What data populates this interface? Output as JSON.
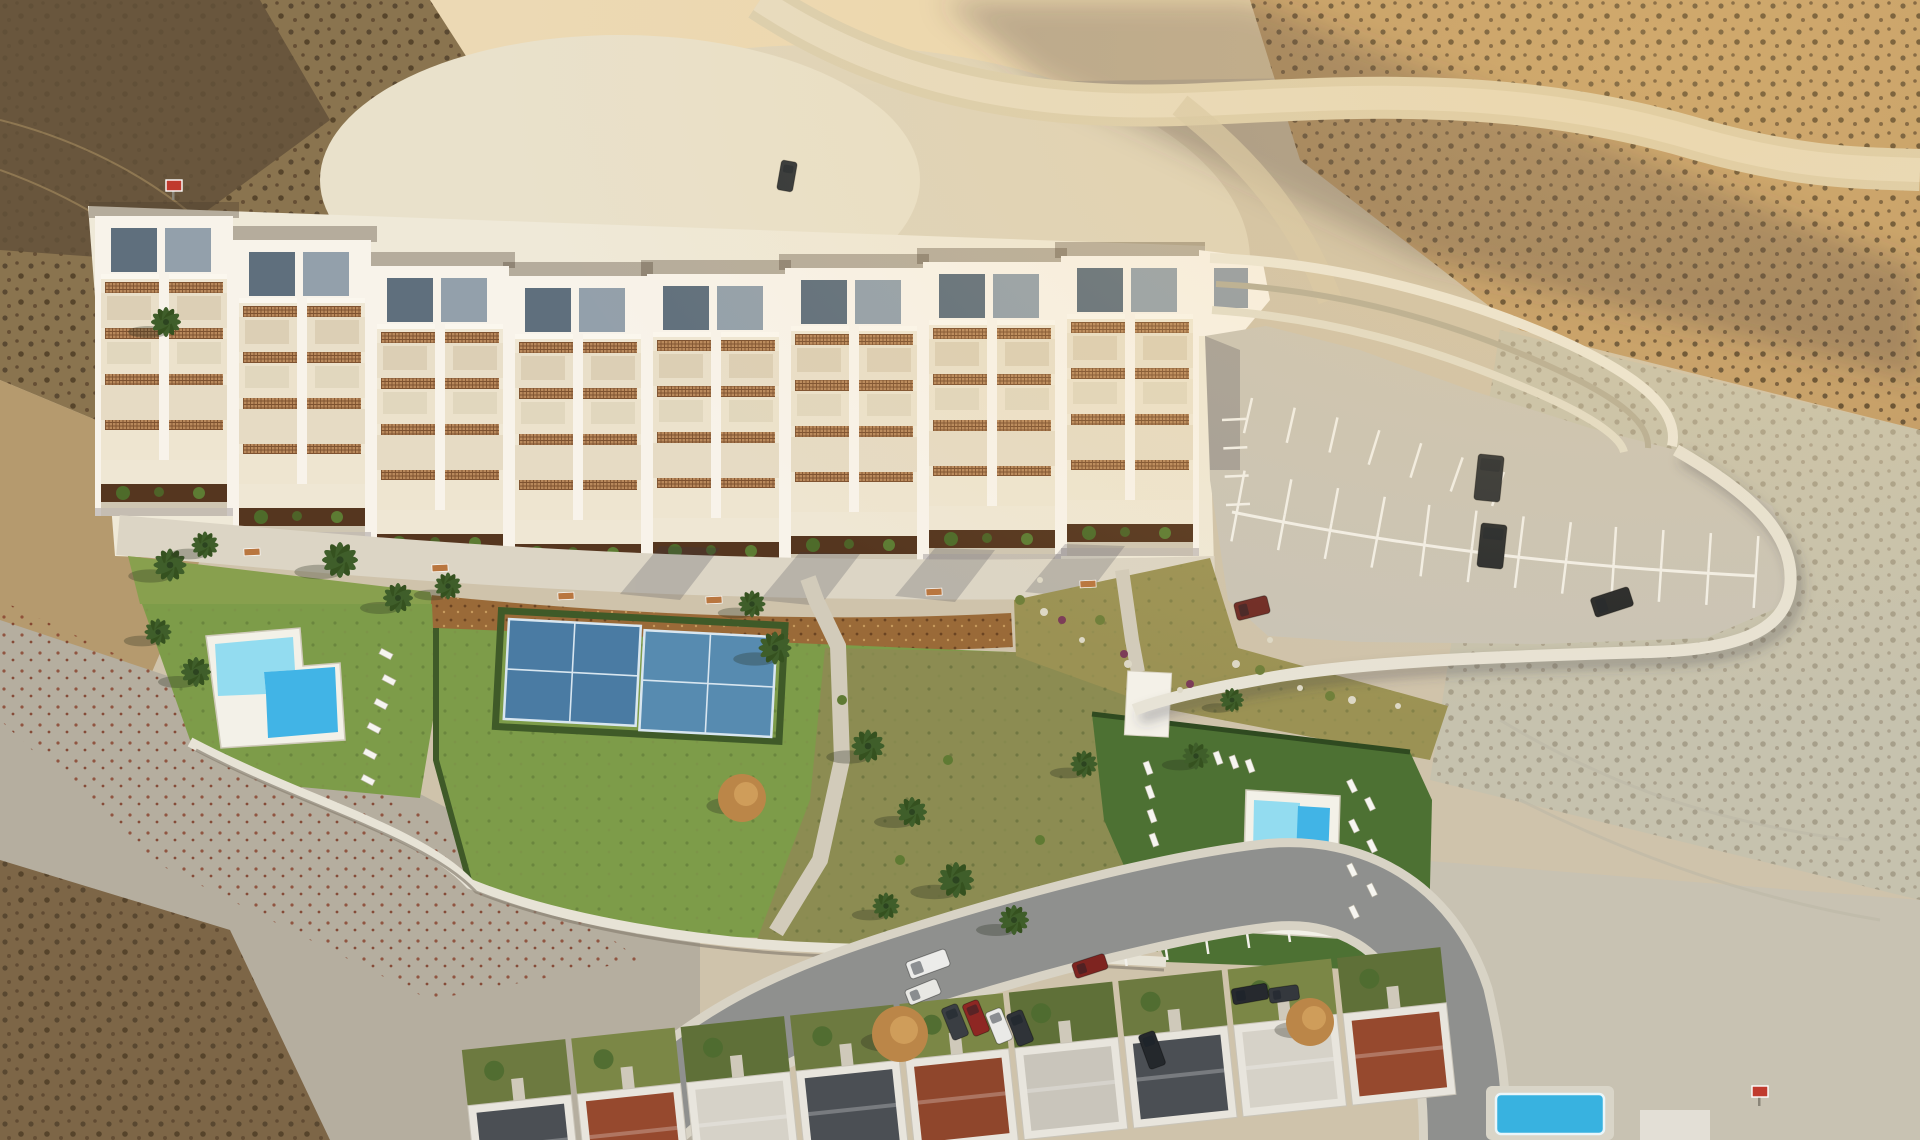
{
  "scene": {
    "kind": "aerial-photo-render",
    "colors": {
      "terrain_base": "#cfc3ab",
      "sun_sand": "#ecd9b4",
      "scrub_brown": "#8a744f",
      "scrub_dark": "#63513a",
      "pale_ground": "#ded5bd",
      "pale_bright": "#e9e1cb",
      "warm_slope": "#c09a66",
      "right_pale": "#c6c2ae",
      "leftlow_gray": "#b5ae9f",
      "corner_scrub": "#7d6647",
      "dirt_road": "#dbcfb0",
      "dirt_road_hi": "#e7dcc2",
      "building_cream": "#efe7d4",
      "building_white": "#f8f3ea",
      "roof_panel_dark": "#5f6f7d",
      "roof_panel_light": "#93a0ab",
      "lattice": "#b9895c",
      "lattice_line": "#7e5230",
      "planter": "#55361f",
      "shrub": "#4e6b2a",
      "promenade": "#dcd5c5",
      "mulch": "#9a6a38",
      "lawn": "#7d9c49",
      "lawn_dry": "#88a04e",
      "olive": "#8c8c52",
      "rough": "#9b9254",
      "lawn_dark": "#4d7133",
      "pool_deck": "#f3f1e8",
      "pool_light": "#93dcf0",
      "pool_deep": "#41b4e6",
      "court": "#4a7ba3",
      "court_alt": "#578bb0",
      "court_line": "#d8e6f0",
      "path": "#d2cbba",
      "wall": "#e7e3d6",
      "wall_shadow": "#8a8273",
      "parking": "#c9c4b7",
      "stripe": "#f2f0ea",
      "road": "#8f908e",
      "sidewalk": "#d8d3c5",
      "house_wall": "#e8e5dd",
      "roof_charcoal": "#4b4f54",
      "roof_terra": "#96492e",
      "roof_light": "#d6d2c8",
      "yard": "#6d7a40",
      "palm": "#3f5e2a",
      "autumn": "#bb8648",
      "bench": "#b9763f",
      "sign_red": "#c03a2e",
      "shadow": "rgba(58,54,66,0.32)"
    },
    "buildings": {
      "modules": [
        {
          "x": 95,
          "y": 216
        },
        {
          "x": 233,
          "y": 240
        },
        {
          "x": 371,
          "y": 266
        },
        {
          "x": 509,
          "y": 276
        },
        {
          "x": 647,
          "y": 274
        },
        {
          "x": 785,
          "y": 268
        },
        {
          "x": 923,
          "y": 262
        },
        {
          "x": 1061,
          "y": 256
        }
      ]
    },
    "benches": [
      [
        252,
        552
      ],
      [
        440,
        568
      ],
      [
        566,
        596
      ],
      [
        714,
        600
      ],
      [
        934,
        592
      ],
      [
        1088,
        584
      ]
    ],
    "palms": [
      [
        166,
        322,
        1.0
      ],
      [
        170,
        565,
        1.1
      ],
      [
        205,
        545,
        0.9
      ],
      [
        340,
        560,
        1.2
      ],
      [
        398,
        598,
        1.0
      ],
      [
        448,
        586,
        0.9
      ],
      [
        158,
        632,
        0.9
      ],
      [
        196,
        672,
        1.0
      ],
      [
        752,
        604,
        0.9
      ],
      [
        775,
        648,
        1.1
      ],
      [
        868,
        746,
        1.1
      ],
      [
        912,
        812,
        1.0
      ],
      [
        956,
        880,
        1.2
      ],
      [
        886,
        906,
        0.9
      ],
      [
        1014,
        920,
        1.0
      ],
      [
        1084,
        764,
        0.9
      ],
      [
        1196,
        756,
        0.9
      ],
      [
        1232,
        700,
        0.8
      ]
    ],
    "autumn_trees": [
      [
        742,
        798,
        24
      ],
      [
        900,
        1034,
        28
      ],
      [
        1310,
        1022,
        24
      ]
    ],
    "loungers": {
      "left": [
        [
          386,
          654
        ],
        [
          389,
          680
        ],
        [
          381,
          704
        ],
        [
          374,
          728
        ],
        [
          370,
          754
        ],
        [
          368,
          780
        ]
      ],
      "right_a": [
        [
          1148,
          768
        ],
        [
          1150,
          792
        ],
        [
          1152,
          816
        ],
        [
          1154,
          840
        ],
        [
          1218,
          758
        ],
        [
          1234,
          762
        ],
        [
          1250,
          766
        ]
      ],
      "right_b": [
        [
          1352,
          786
        ],
        [
          1370,
          804
        ],
        [
          1354,
          826
        ],
        [
          1372,
          846
        ],
        [
          1352,
          870
        ],
        [
          1372,
          890
        ],
        [
          1354,
          912
        ]
      ]
    },
    "cars": {
      "street": [
        {
          "x": 928,
          "y": 964,
          "w": 42,
          "h": 18,
          "rot": -20,
          "c": "#ececea"
        },
        {
          "x": 923,
          "y": 992,
          "w": 34,
          "h": 16,
          "rot": -22,
          "c": "#e8e8e4"
        },
        {
          "x": 955,
          "y": 1022,
          "w": 17,
          "h": 34,
          "rot": -22,
          "c": "#3a3e43"
        },
        {
          "x": 976,
          "y": 1018,
          "w": 17,
          "h": 34,
          "rot": -22,
          "c": "#8e2723"
        },
        {
          "x": 999,
          "y": 1026,
          "w": 17,
          "h": 34,
          "rot": -22,
          "c": "#eaeae7"
        },
        {
          "x": 1020,
          "y": 1028,
          "w": 17,
          "h": 34,
          "rot": -22,
          "c": "#2f3338"
        },
        {
          "x": 1090,
          "y": 966,
          "w": 34,
          "h": 16,
          "rot": -18,
          "c": "#7e2420"
        },
        {
          "x": 1152,
          "y": 1050,
          "w": 17,
          "h": 36,
          "rot": -20,
          "c": "#24282c"
        },
        {
          "x": 1250,
          "y": 994,
          "w": 36,
          "h": 16,
          "rot": -10,
          "c": "#26292e"
        },
        {
          "x": 1284,
          "y": 994,
          "w": 30,
          "h": 15,
          "rot": -8,
          "c": "#34383d"
        }
      ],
      "parking": [
        {
          "x": 1489,
          "y": 478,
          "w": 26,
          "h": 46,
          "rot": 6,
          "c": "#2c3034"
        },
        {
          "x": 1492,
          "y": 546,
          "w": 26,
          "h": 44,
          "rot": 6,
          "c": "#24282c"
        },
        {
          "x": 1252,
          "y": 608,
          "w": 34,
          "h": 18,
          "rot": -14,
          "c": "#6e2a25"
        },
        {
          "x": 1612,
          "y": 602,
          "w": 40,
          "h": 20,
          "rot": -18,
          "c": "#222528"
        }
      ],
      "dirt_road": [
        {
          "x": 787,
          "y": 176,
          "w": 16,
          "h": 30,
          "rot": 10,
          "c": "#2f3438"
        }
      ]
    },
    "parking_rows": [
      {
        "pts": [
          [
            1252,
            398
          ],
          [
            1340,
            418
          ],
          [
            1430,
            446
          ],
          [
            1504,
            472
          ]
        ],
        "count": 7,
        "len": 36,
        "side": 1
      },
      {
        "pts": [
          [
            1238,
            506
          ],
          [
            1420,
            540
          ],
          [
            1600,
            562
          ],
          [
            1756,
            572
          ]
        ],
        "count": 12,
        "len": 36,
        "side": -1
      },
      {
        "pts": [
          [
            1238,
            506
          ],
          [
            1420,
            540
          ],
          [
            1600,
            562
          ],
          [
            1756,
            572
          ]
        ],
        "count": 12,
        "len": 36,
        "side": 1
      },
      {
        "pts": [
          [
            1222,
            420
          ],
          [
            1226,
            505
          ]
        ],
        "count": 4,
        "len": 24,
        "side": -1
      },
      {
        "pts": [
          [
            1045,
            978
          ],
          [
            1290,
            942
          ]
        ],
        "count": 7,
        "len": 20,
        "side": -1
      }
    ],
    "houses": {
      "units": [
        {
          "x": 470,
          "roof": "#4b4f54",
          "yard": "#6d7a40"
        },
        {
          "x": 580,
          "roof": "#96492e",
          "yard": "#7b8746"
        },
        {
          "x": 690,
          "roof": "#d6d2c8",
          "yard": "#5f7038"
        },
        {
          "x": 800,
          "roof": "#4b4f54",
          "yard": "#6d7a40"
        },
        {
          "x": 910,
          "roof": "#8f462c",
          "yard": "#7b8746"
        },
        {
          "x": 1020,
          "roof": "#c9c5bb",
          "yard": "#5f7038"
        },
        {
          "x": 1130,
          "roof": "#4b4f54",
          "yard": "#6d7a40"
        },
        {
          "x": 1240,
          "roof": "#d6d2c8",
          "yard": "#7b8746"
        },
        {
          "x": 1350,
          "roof": "#96492e",
          "yard": "#5f7038"
        }
      ]
    },
    "stones": [
      [
        1044,
        612,
        4
      ],
      [
        1082,
        640,
        3
      ],
      [
        1128,
        664,
        4
      ],
      [
        1180,
        690,
        3
      ],
      [
        1236,
        664,
        4
      ],
      [
        1300,
        688,
        3
      ],
      [
        1352,
        700,
        4
      ],
      [
        1398,
        706,
        3
      ],
      [
        1270,
        640,
        3
      ],
      [
        1040,
        580,
        3
      ]
    ],
    "shrubs_magenta": [
      [
        1062,
        620
      ],
      [
        1124,
        654
      ],
      [
        1190,
        684
      ]
    ],
    "tufts_rough": [
      [
        1100,
        620
      ],
      [
        1260,
        670
      ],
      [
        1330,
        696
      ],
      [
        1020,
        600
      ]
    ],
    "tufts_central": [
      [
        842,
        700
      ],
      [
        948,
        760
      ],
      [
        1040,
        840
      ],
      [
        900,
        860
      ]
    ],
    "signs": [
      [
        166,
        180
      ],
      [
        1752,
        1086
      ]
    ]
  }
}
